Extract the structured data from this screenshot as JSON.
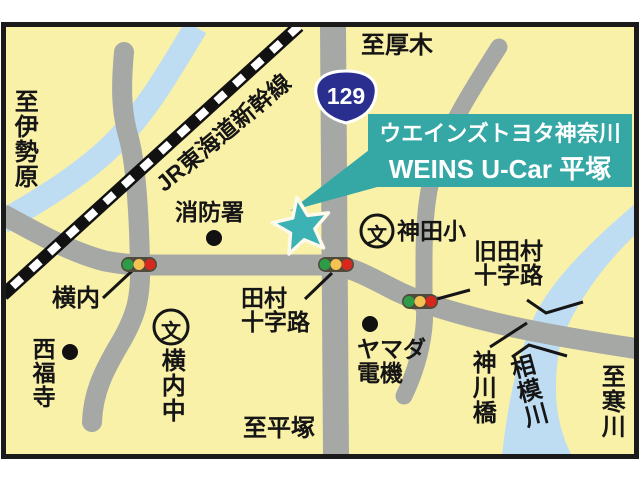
{
  "map": {
    "callout": {
      "line1": "ウエインズトヨタ神奈川",
      "line2": "WEINS U-Car 平塚"
    },
    "route_shield": {
      "number": "129"
    },
    "railway": {
      "label": "JR東海道新幹線"
    },
    "directions": {
      "north": "至厚木",
      "west": "至伊勢原",
      "south": "至平塚",
      "east": "至寒川"
    },
    "labels": {
      "fire_station": "消防署",
      "school_mark": "文",
      "kanda_elementary": "神田小",
      "yokouchi_signal": "横内",
      "nishifukuji_temple": "西福寺",
      "yokouchi_junior_high": "横内中",
      "yamada_line1": "ヤマダ",
      "yamada_line2": "電機",
      "tamura_line1": "田村",
      "tamura_line2": "十字路",
      "kyu_tamura_line1": "旧田村",
      "kyu_tamura_line2": "十字路",
      "kangawa_bridge": "神川橋",
      "sagami_river": "相模川"
    },
    "colors": {
      "background": "#FAF1A8",
      "road": "#A5A8A5",
      "river": "#BFDDF2",
      "frame": "#1A1A1A",
      "callout_teal": "#35A8A6",
      "star_teal": "#3CB2B5",
      "shield_blue": "#2A2F8F",
      "signal_body": "#4F4A3A",
      "signal_green": "#2E9C46",
      "signal_yellow": "#F5C152",
      "signal_red": "#D5291F"
    }
  }
}
